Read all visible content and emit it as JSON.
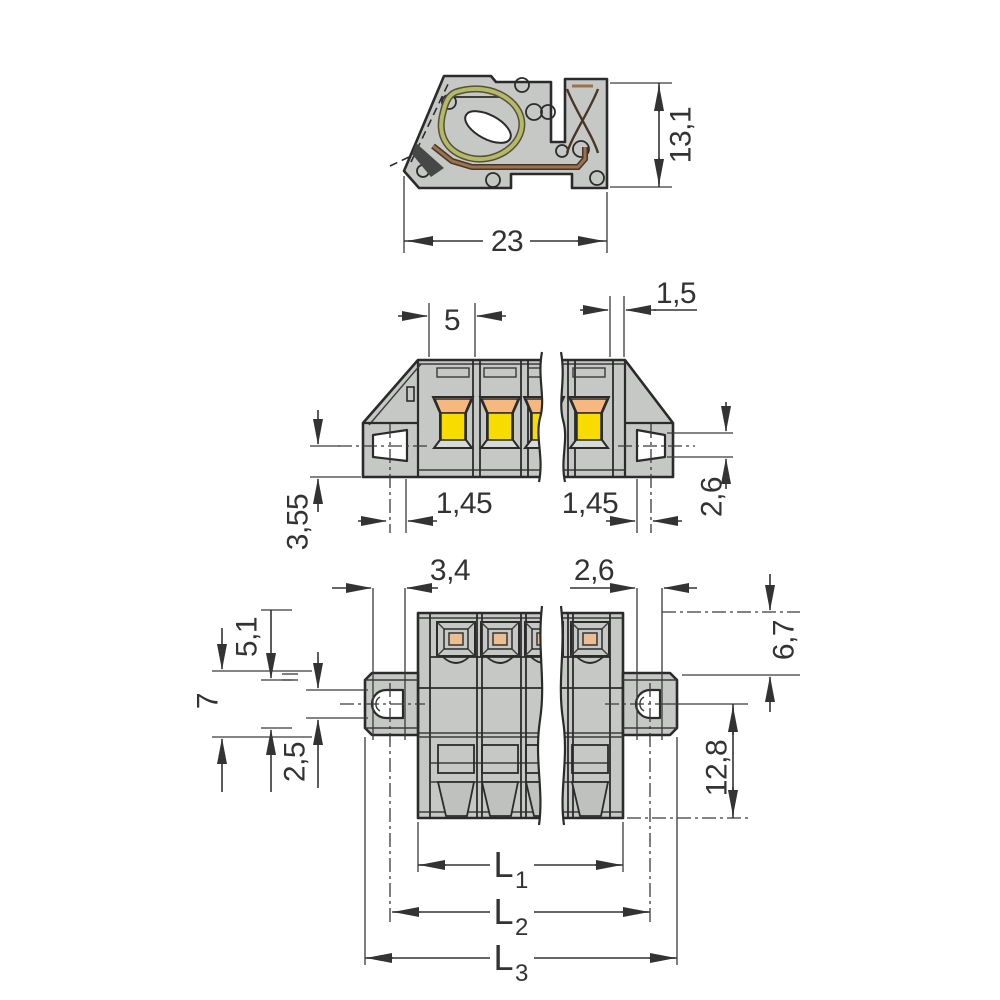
{
  "drawing": {
    "type": "technical-dimension-drawing",
    "colors": {
      "body_grey": "#c6c8c6",
      "bevel_grey": "#d8dad8",
      "window_yellow": "#f8dc00",
      "window_orange": "#f5b87e",
      "square_orange": "#ecbf92",
      "spring_olive": "#b5ba69",
      "copper": "#9b7250",
      "line": "#2b2b2b"
    },
    "views": {
      "side_section": {
        "name": "side cross-section",
        "dim_width": "23",
        "dim_height": "13,1"
      },
      "front": {
        "name": "front view",
        "dim_pitch": "5",
        "dim_edge": "1,5",
        "dim_flange_left": "1,45",
        "dim_flange_right": "1,45",
        "dim_height_left": "3,55",
        "dim_slot_height": "2,6"
      },
      "plan": {
        "name": "top view",
        "dim_slot_w_left": "3,4",
        "dim_slot_w_right": "2,6",
        "dim_left_a": "5,1",
        "dim_left_b": "7",
        "dim_left_c": "2,5",
        "dim_right_a": "6,7",
        "dim_right_b": "12,8",
        "lengths": [
          {
            "base": "L",
            "sub": "1"
          },
          {
            "base": "L",
            "sub": "2"
          },
          {
            "base": "L",
            "sub": "3"
          }
        ]
      }
    }
  }
}
